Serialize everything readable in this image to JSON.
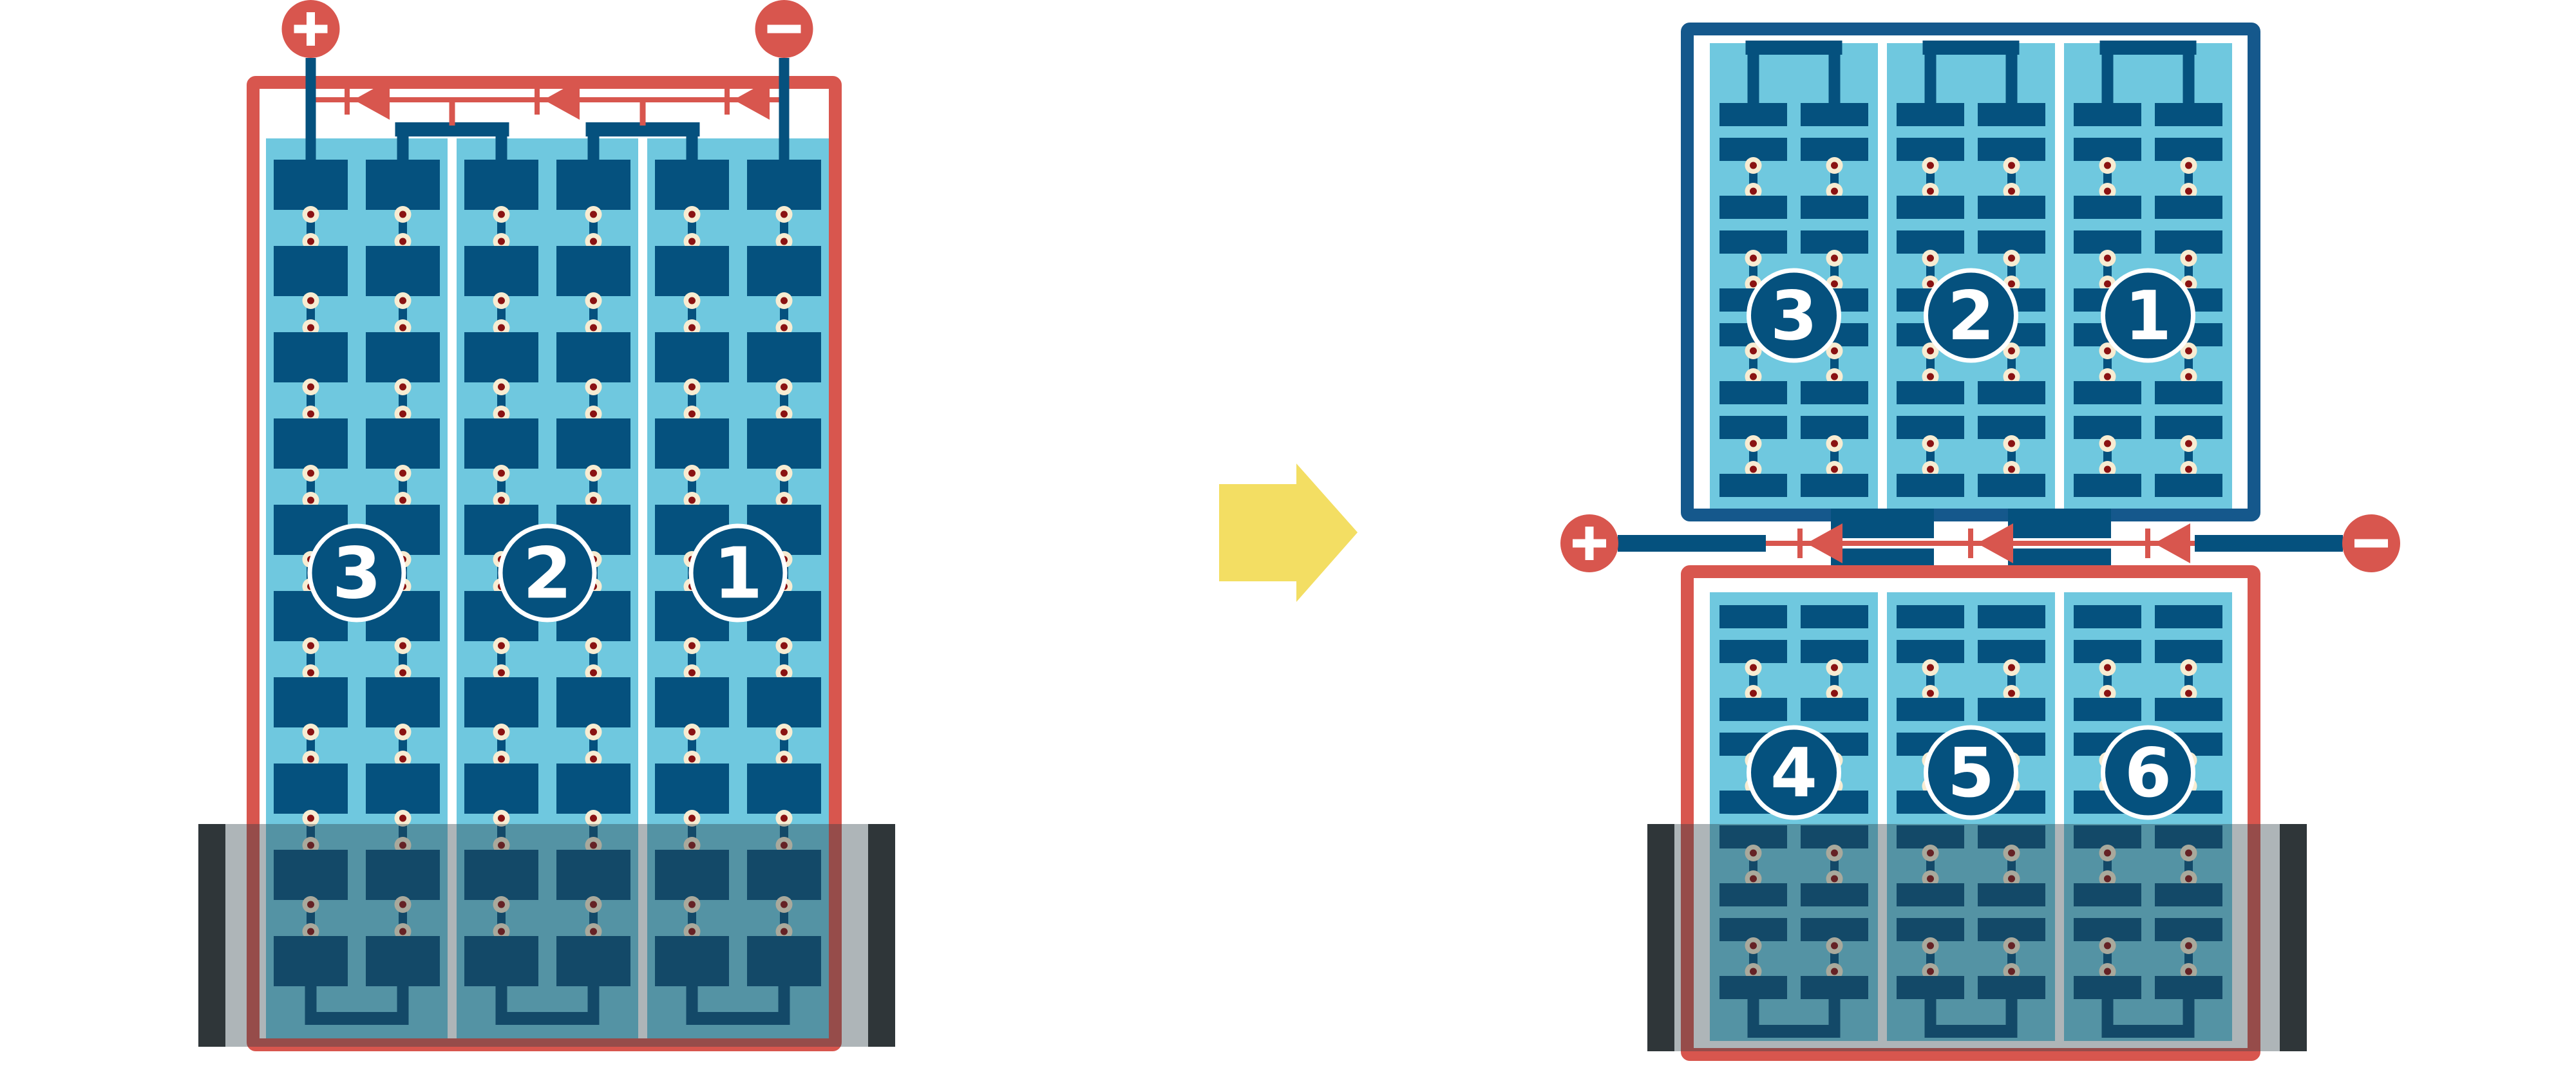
{
  "diagram": {
    "description": "Battery/PV string enclosure rewired above flood line",
    "left_panel": {
      "labels": [
        "3",
        "2",
        "1"
      ]
    },
    "right_top_panel": {
      "labels": [
        "3",
        "2",
        "1"
      ]
    },
    "right_bottom_panel": {
      "labels": [
        "4",
        "5",
        "6"
      ]
    },
    "terminals": {
      "positive_label": "+",
      "negative_label": "−"
    },
    "colors": {
      "red": "#D8564E",
      "navy": "#05517E",
      "navy_border": "#15588C",
      "light_blue": "#6FC8DF",
      "cream": "#F7ECD2",
      "maroon": "#8A1212",
      "yellow": "#F3DE63",
      "flood_overlay": "rgba(43,60,69,0.38)",
      "wall_bar": "#333333",
      "white": "#FFFFFF"
    }
  }
}
